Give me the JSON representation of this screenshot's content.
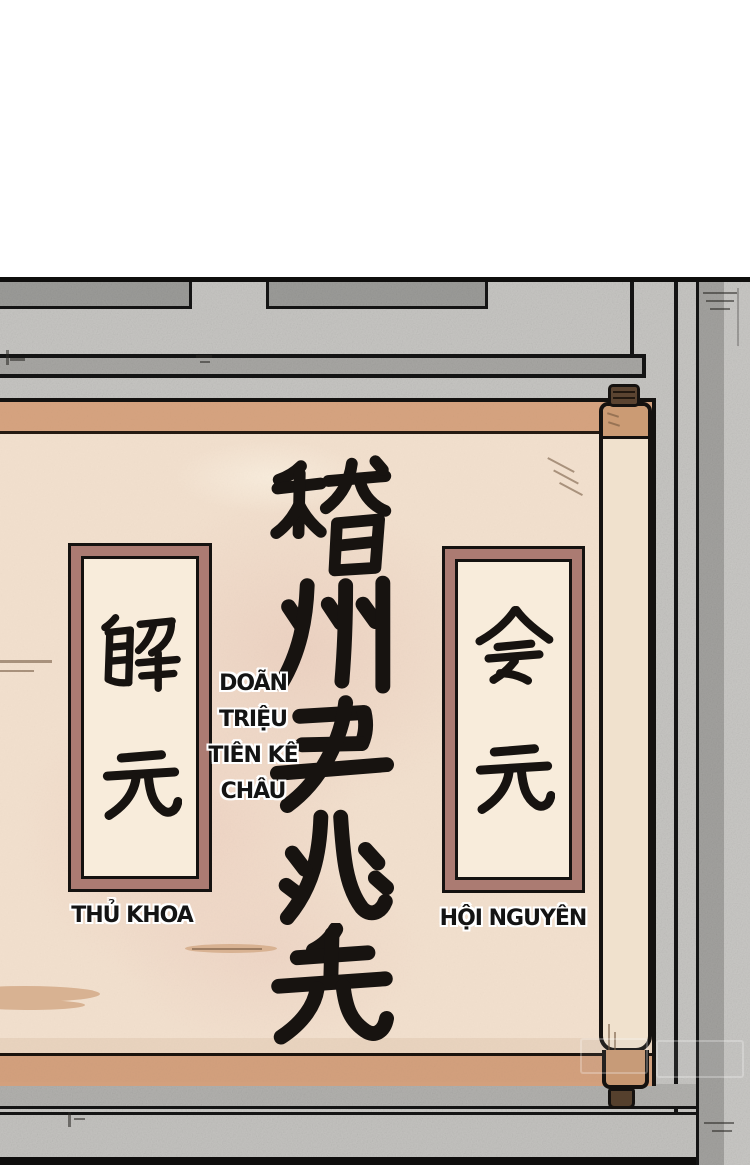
{
  "comic": {
    "scroll": {
      "calligraphy": {
        "text": "稽州尹兆先",
        "chars": [
          "稽",
          "州",
          "尹",
          "兆",
          "先"
        ]
      },
      "left_placard": {
        "text": "解元",
        "chars": [
          "解",
          "元"
        ],
        "caption": "THỦ KHOA"
      },
      "right_placard": {
        "text": "会元",
        "chars": [
          "会",
          "元"
        ],
        "caption": "HỘI NGUYÊN"
      },
      "translation_note": {
        "full": "DOÃN TRIỆU TIÊN KÊ CHÂU",
        "lines": [
          "DOÃN",
          "TRIỆU",
          "TIÊN KÊ",
          "CHÂU"
        ]
      }
    },
    "colors": {
      "background_top": "#ffffff",
      "wall_light": "#c7c6c3",
      "wall_dark_panel": "#9c9c99",
      "wall_beam": "#a8a7a4",
      "paper": "#f2e0ce",
      "paper_wash": "#ecd2c2",
      "scroll_border_tan": "#d6a380",
      "placard_frame": "#ab7b72",
      "placard_inner": "#f8ecdb",
      "roller_body": "#f0e1cd",
      "roller_collar": "#cb9b74",
      "roller_knob": "#5b4431",
      "ink": "#171310",
      "outline": "#141414"
    }
  }
}
